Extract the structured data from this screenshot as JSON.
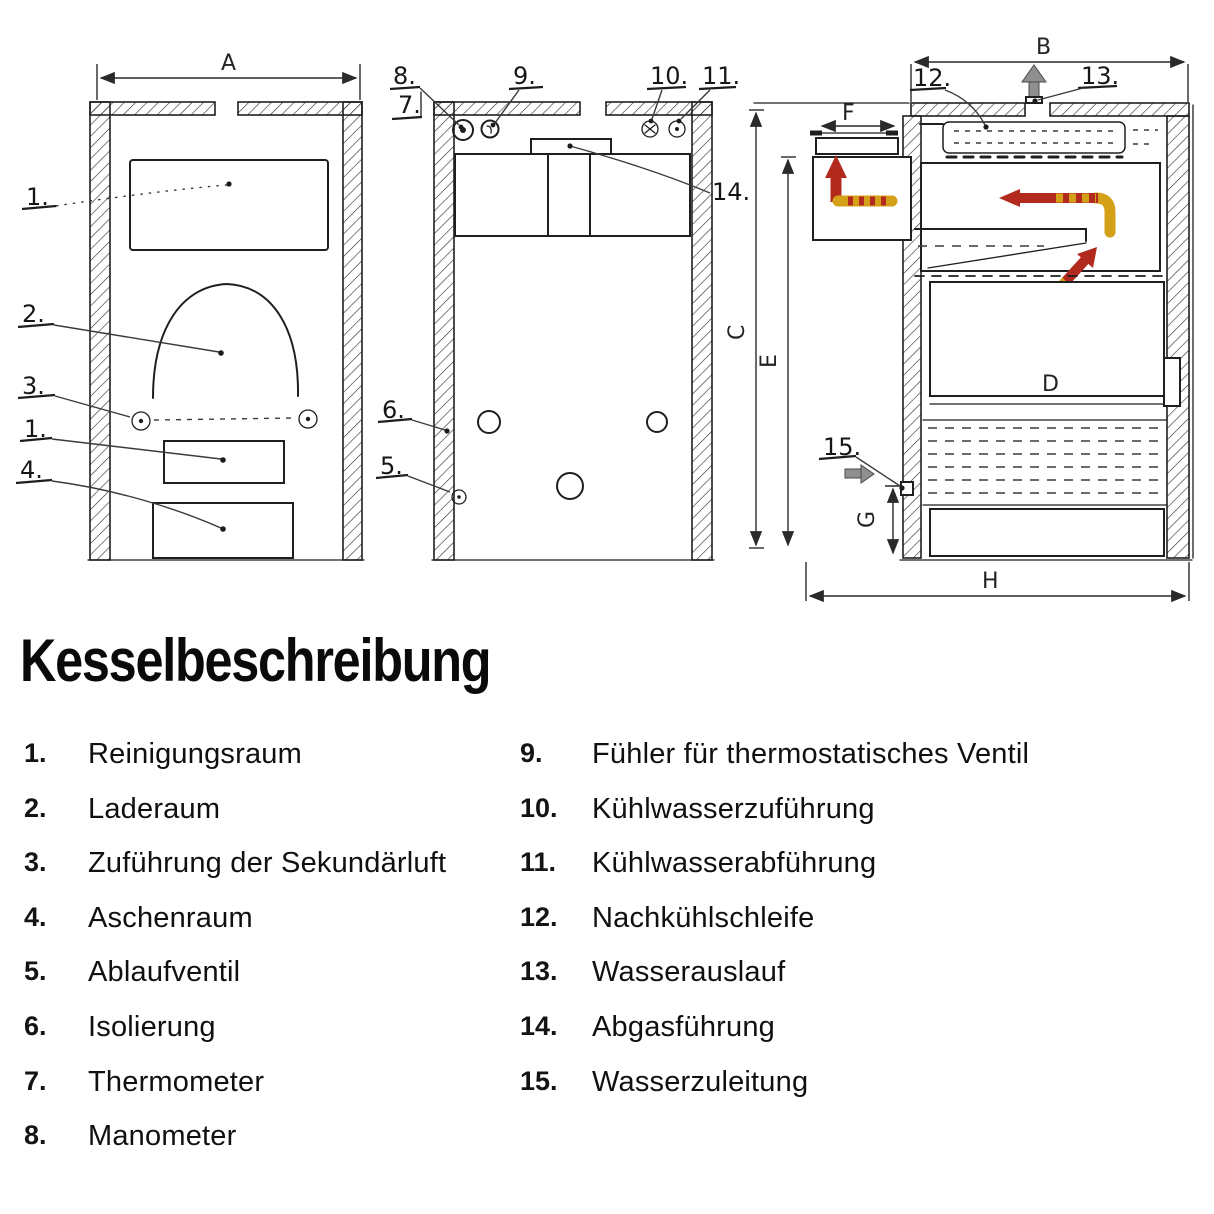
{
  "title": "Kesselbeschreibung",
  "legend": {
    "left": [
      {
        "num": "1.",
        "label": "Reinigungsraum"
      },
      {
        "num": "2.",
        "label": "Laderaum"
      },
      {
        "num": "3.",
        "label": "Zuführung der Sekundärluft"
      },
      {
        "num": "4.",
        "label": "Aschenraum"
      },
      {
        "num": "5.",
        "label": "Ablaufventil"
      },
      {
        "num": "6.",
        "label": "Isolierung"
      },
      {
        "num": "7.",
        "label": "Thermometer"
      },
      {
        "num": "8.",
        "label": "Manometer"
      }
    ],
    "right": [
      {
        "num": "9.",
        "label": "Fühler für thermostatisches Ventil"
      },
      {
        "num": "10.",
        "label": "Kühlwasserzuführung"
      },
      {
        "num": "11.",
        "label": "Kühlwasserabführung"
      },
      {
        "num": "12.",
        "label": "Nachkühlschleife"
      },
      {
        "num": "13.",
        "label": "Wasserauslauf"
      },
      {
        "num": "14.",
        "label": "Abgasführung"
      },
      {
        "num": "15.",
        "label": "Wasserzuleitung"
      }
    ]
  },
  "diagram": {
    "front": {
      "dim_a": "A",
      "callouts": {
        "c1": "1.",
        "c2": "2.",
        "c3": "3.",
        "c1b": "1.",
        "c4": "4."
      }
    },
    "rear": {
      "callouts": {
        "c7": "7.",
        "c8": "8.",
        "c9": "9.",
        "c10": "10.",
        "c11": "11.",
        "c14": "14.",
        "c6": "6.",
        "c5": "5."
      }
    },
    "side": {
      "dims": {
        "b": "B",
        "c": "C",
        "d": "D",
        "e": "E",
        "f": "F",
        "g": "G",
        "h": "H"
      },
      "callouts": {
        "c12": "12.",
        "c13": "13.",
        "c15": "15."
      }
    }
  },
  "colors": {
    "ink": "#1f1f1f",
    "hot_gas_arrow": "#b22a1d",
    "warm_gas_arrow": "#d4a017",
    "block_arrow_gray": "#8f8f8f",
    "background": "#ffffff"
  }
}
